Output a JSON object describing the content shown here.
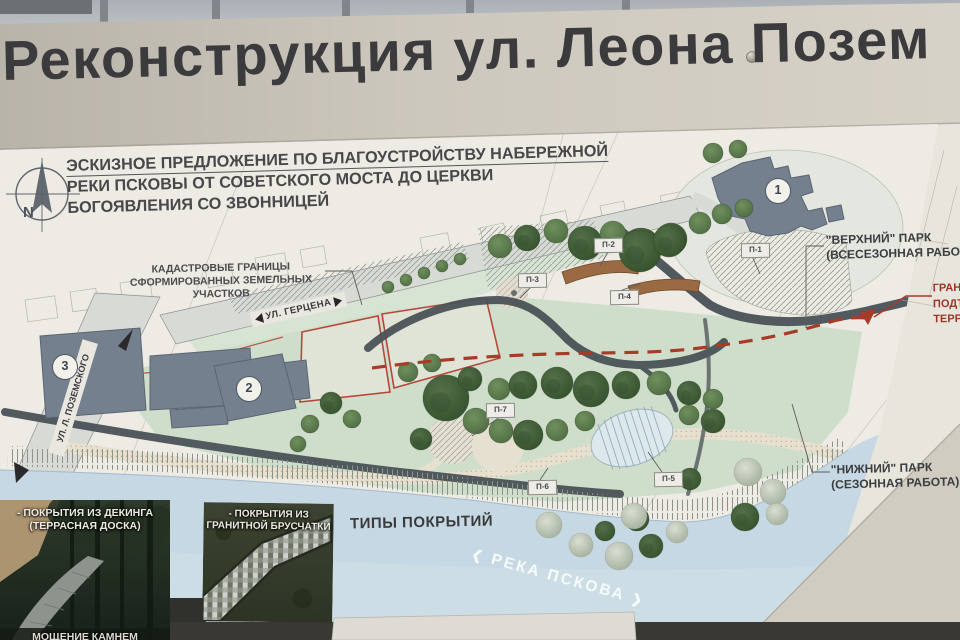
{
  "title": "Реконструкция ул. Леона Позем",
  "compass": {
    "letter": "N"
  },
  "legend": {
    "line1": "ЭСКИЗНОЕ ПРЕДЛОЖЕНИЕ ПО БЛАГОУСТРОЙСТВУ НАБЕРЕЖНОЙ",
    "line2": "РЕКИ ПСКОВЫ ОТ СОВЕТСКОГО МОСТА ДО ЦЕРКВИ",
    "line3": "БОГОЯВЛЕНИЯ СО ЗВОННИЦЕЙ"
  },
  "map": {
    "cadastral_line1": "КАДАСТРОВЫЕ ГРАНИЦЫ",
    "cadastral_line2": "СФОРМИРОВАННЫХ ЗЕМЕЛЬНЫХ УЧАСТКОВ",
    "street_gertsena": "УЛ. ГЕРЦЕНА",
    "street_pozemskogo": "УЛ. Л. ПОЗЕМСКОГО",
    "upper_park_line1": "\"ВЕРХНИЙ\" ПАРК",
    "upper_park_line2": "(ВСЕСЕЗОННАЯ РАБОТА)",
    "lower_park_line1": "\"НИЖНИЙ\" ПАРК",
    "lower_park_line2": "(СЕЗОННАЯ РАБОТА)",
    "flood_line1": "ГРАНИ",
    "flood_line2": "ПОДТ",
    "flood_line3": "ТЕРР",
    "river_bracket_left": "❮",
    "river_label": "РЕКА ПСКОВА",
    "river_bracket_right": "❯",
    "area_markers": [
      "П-1",
      "П-2",
      "П-3",
      "П-4",
      "П-5",
      "П-6",
      "П-7"
    ],
    "building_numbers": [
      "1",
      "2",
      "3"
    ]
  },
  "coverings": {
    "header": "ТИПЫ ПОКРЫТИЙ",
    "photo1_line1": "- ПОКРЫТИЯ ИЗ ДЕКИНГА",
    "photo1_line2": "(ТЕРРАСНАЯ ДОСКА)",
    "photo1_bottom": "МОЩЕНИЕ КАМНЕМ",
    "photo2_line1": "- ПОКРЫТИЯ ИЗ",
    "photo2_line2": "ГРАНИТНОЙ БРУСЧАТКИ"
  },
  "colors": {
    "board": "#cdc8be",
    "sheet": "#e7e5dc",
    "park_green": "#cfdecb",
    "river_blue": "#c6d8e3",
    "building": "#74808d",
    "path_dark": "#4a5257",
    "decking_brown": "#9a6a42",
    "accent_red": "#a03828"
  }
}
